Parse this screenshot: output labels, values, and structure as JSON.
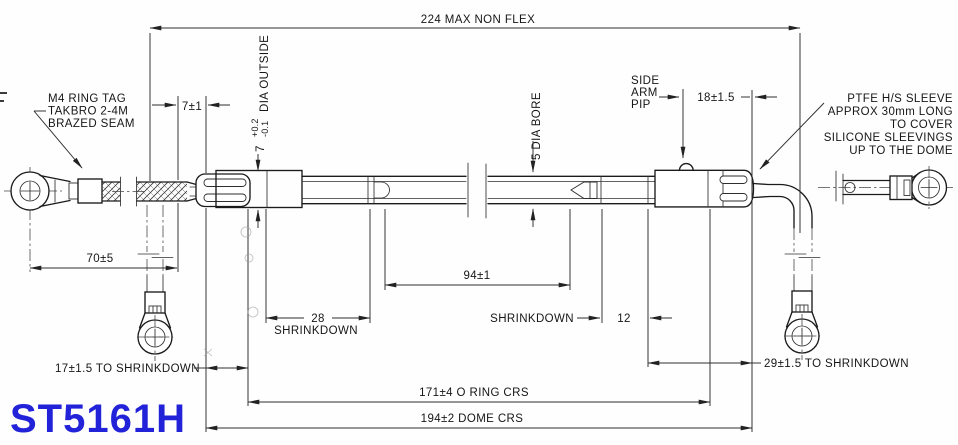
{
  "part_number": "ST5161H",
  "colors": {
    "part_number": "#2222d8",
    "line": "#1b1b1b"
  },
  "dims": {
    "overall": "224 MAX NON FLEX",
    "seven": "7±1",
    "dia": {
      "value": "7",
      "tol_plus": "+0.2",
      "tol_minus": "-0.1",
      "label": "DIA OUTSIDE"
    },
    "bore": "5 DIA BORE",
    "pip": [
      "SIDE",
      "ARM",
      "PIP"
    ],
    "eighteen": "18±1.5",
    "seventy": "70±5",
    "seventeen": "17±1.5 TO SHRINKDOWN",
    "twenty_eight": {
      "value": "28",
      "label": "SHRINKDOWN"
    },
    "ninety_four": "94±1",
    "twelve": {
      "label": "SHRINKDOWN",
      "value": "12"
    },
    "twenty_nine": "29±1.5 TO SHRINKDOWN",
    "o_ring_crs": "171±4 O RING CRS",
    "dome_crs": "194±2 DOME CRS"
  },
  "notes": {
    "left_tag": [
      "M4 RING TAG",
      "TAKBRO 2-4M",
      "BRAZED SEAM"
    ],
    "ptfe": [
      "PTFE H/S SLEEVE",
      "APPROX 30mm LONG",
      "TO COVER",
      "SILICONE SLEEVINGS",
      "UP TO THE DOME"
    ]
  }
}
